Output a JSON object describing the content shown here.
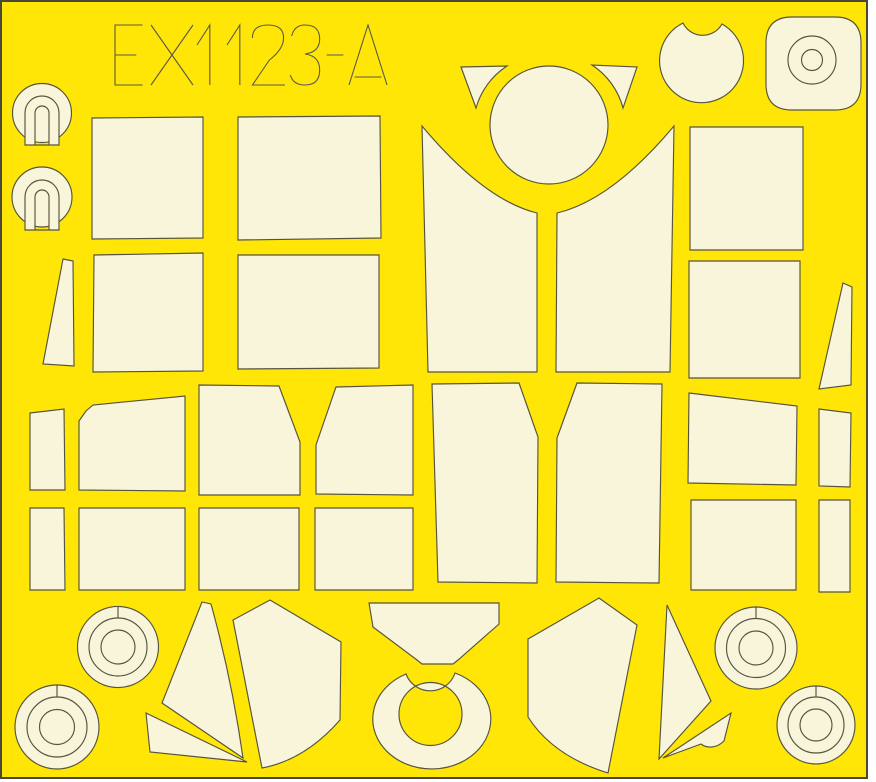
{
  "sheet": {
    "label": "EX1123-A",
    "width": 876,
    "height": 782,
    "colors": {
      "background": "#FFE606",
      "piece": "#F8F5DA",
      "outline": "#55543F",
      "border": "#4A4939",
      "label_stroke": "#5A594A",
      "page": "#FFFFFF"
    },
    "label_layout": {
      "x_positions": [
        115,
        151,
        197,
        227,
        251,
        289,
        325,
        349
      ],
      "glyph_widths": [
        30,
        42,
        22,
        22,
        34,
        32,
        20,
        38
      ],
      "top_y": 25,
      "glyph_height": 60
    }
  },
  "pieces": [
    {
      "name": "gunsight-mask-top-disc",
      "d": "M 12.5 113 A 29.5 29.5 0 1 0 71.5 113 A 29.5 29.5 0 1 0 12.5 113 Z",
      "fill": "piece"
    },
    {
      "name": "gunsight-mask-top-keyhole",
      "d": "M 25 145 L 25 113 A 17 17 0 0 1 59 113 L 59 145 Z M 35 145 L 35 113 A 7 7 0 0 1 49 113 L 49 145 Z",
      "fill": "piece",
      "rule": "evenodd"
    },
    {
      "name": "gunsight-mask-bottom-disc",
      "d": "M 12 197 A 30 30 0 1 0 72 197 A 30 30 0 1 0 12 197 Z",
      "fill": "piece"
    },
    {
      "name": "gunsight-mask-bottom-keyhole",
      "d": "M 25 230 L 25 197 A 17 17 0 0 1 59 197 L 59 230 Z M 35 230 L 35 197 A 7 7 0 0 1 49 197 L 49 230 Z",
      "fill": "piece",
      "rule": "evenodd"
    },
    {
      "name": "fuselage-rect-mask-a1",
      "d": "M 92 118 L 203 117 L 203 238 L 92 239 Z",
      "fill": "piece"
    },
    {
      "name": "fuselage-rect-mask-a2",
      "d": "M 238 117 L 380 116 L 381 238 L 238 240 Z",
      "fill": "piece"
    },
    {
      "name": "fuselage-rect-mask-b1",
      "d": "M 94 255 L 203 253 L 203 371 L 93 372 Z",
      "fill": "piece"
    },
    {
      "name": "fuselage-rect-mask-b2",
      "d": "M 238 255 L 379 255 L 379 368 L 238 369 Z",
      "fill": "piece"
    },
    {
      "name": "edge-wedge-mask-left",
      "d": "M 63 259 L 73 261 L 74 366 L 43 364 Z",
      "fill": "piece"
    },
    {
      "name": "windscreen-quarter-mask-left",
      "d": "M 422 126 Q 484 200 537 213 L 537 372 L 428 372 Z",
      "fill": "piece"
    },
    {
      "name": "windscreen-quarter-mask-right",
      "d": "M 674 126 Q 612 200 557 213 L 556 372 L 670 372 Z",
      "fill": "piece"
    },
    {
      "name": "canopy-crown-circle-mask",
      "d": "M 490 125 A 59 59 0 1 0 608 125 A 59 59 0 1 0 490 125 Z",
      "fill": "piece"
    },
    {
      "name": "horn-triangle-mask-left",
      "d": "M 461 67 L 507 66 A 74 74 0 0 0 476 108 Z",
      "fill": "piece"
    },
    {
      "name": "horn-triangle-mask-right",
      "d": "M 637 67 L 592 65 A 74 74 0 0 1 623 108 Z",
      "fill": "piece"
    },
    {
      "name": "notched-disc-mask",
      "d": "M 683 23 A 42 42 0 1 0 722 24 A 22 22 0 0 1 683 23 Z",
      "fill": "piece"
    },
    {
      "name": "rounded-square-mask",
      "d": "M 792 17 L 835 17 Q 861 17 861 43 L 861 84 Q 861 110 835 110 L 792 110 Q 766 110 766 84 L 766 43 Q 766 17 792 17 Z",
      "fill": "piece"
    },
    {
      "name": "rounded-square-ring-cut",
      "d": "M 788 60 A 24 24 0 1 0 836 60 A 24 24 0 1 0 788 60 Z",
      "fill": "none"
    },
    {
      "name": "rounded-square-hub-cut",
      "d": "M 801.5 60 A 10.5 10.5 0 1 0 822.5 60 A 10.5 10.5 0 1 0 801.5 60 Z",
      "fill": "none"
    },
    {
      "name": "side-rect-mask-right-1",
      "d": "M 690 127 L 803 127 L 803 250 L 690 250 Z",
      "fill": "piece"
    },
    {
      "name": "side-rect-mask-right-2",
      "d": "M 689 261 L 800 261 L 800 378 L 689 378 Z",
      "fill": "piece"
    },
    {
      "name": "tail-wedge-mask-right",
      "d": "M 843 283 L 852 287 L 851 385 L 819 389 Z",
      "fill": "piece"
    },
    {
      "name": "canopy-side-mask-1",
      "d": "M 30 413 L 64 409 L 65 490 L 30 490 Z",
      "fill": "piece"
    },
    {
      "name": "canopy-side-mask-2",
      "d": "M 79 421 L 86 411 L 93 405 L 185 396 L 185 491 L 79 490 Z",
      "fill": "piece"
    },
    {
      "name": "canopy-side-mask-3",
      "d": "M 199 385 L 279 386 L 300 442 L 300 495 L 199 495 Z",
      "fill": "piece"
    },
    {
      "name": "canopy-side-mask-4",
      "d": "M 336 387 L 413 385 L 413 495 L 316 494 L 316 445 Z",
      "fill": "piece"
    },
    {
      "name": "canopy-center-panel-left",
      "d": "M 432 384 L 519 383 L 538 437 L 537 583 L 438 582 Z",
      "fill": "piece"
    },
    {
      "name": "canopy-center-panel-right",
      "d": "M 577 383 L 662 384 L 659 583 L 556 582 L 557 438 Z",
      "fill": "piece"
    },
    {
      "name": "trapezoid-mask-right",
      "d": "M 689 393 L 797 406 L 796 485 L 688 483 Z",
      "fill": "piece"
    },
    {
      "name": "rect-mask-right-lower",
      "d": "M 691 500 L 796 500 L 796 590 L 691 590 Z",
      "fill": "piece"
    },
    {
      "name": "strip-mask-right-upper",
      "d": "M 819 409 L 851 413 L 850 487 L 819 486 Z",
      "fill": "piece"
    },
    {
      "name": "strip-mask-right-lower",
      "d": "M 819 500 L 850 500 L 850 592 L 819 592 Z",
      "fill": "piece"
    },
    {
      "name": "lower-rect-mask-1",
      "d": "M 30 508 L 64 508 L 65 590 L 30 590 Z",
      "fill": "piece"
    },
    {
      "name": "lower-rect-mask-2",
      "d": "M 79 508 L 185 508 L 185 590 L 79 590 Z",
      "fill": "piece"
    },
    {
      "name": "lower-rect-mask-3",
      "d": "M 199 508 L 299 508 L 299 590 L 199 590 Z",
      "fill": "piece"
    },
    {
      "name": "lower-rect-mask-4",
      "d": "M 315 508 L 413 508 L 413 590 L 315 590 Z",
      "fill": "piece"
    },
    {
      "name": "wheel-mask-1-disc",
      "d": "M 77.5 647 A 40.5 40.5 0 1 0 158.5 647 A 40.5 40.5 0 1 0 77.5 647 Z",
      "fill": "piece"
    },
    {
      "name": "wheel-mask-1-ring-cut",
      "d": "M 89 647 A 29 29 0 1 0 147 647 A 29 29 0 1 0 89 647 Z",
      "fill": "none"
    },
    {
      "name": "wheel-mask-1-hub-cut",
      "d": "M 101 647 A 17 17 0 1 0 135 647 A 17 17 0 1 0 101 647 Z",
      "fill": "none"
    },
    {
      "name": "wheel-mask-1-slit",
      "d": "M 118 606.5 L 118 618",
      "fill": "none"
    },
    {
      "name": "wheel-mask-2-disc",
      "d": "M 15 727 A 42 42 0 1 0 99 727 A 42 42 0 1 0 15 727 Z",
      "fill": "piece"
    },
    {
      "name": "wheel-mask-2-ring-cut",
      "d": "M 27 727 A 30 30 0 1 0 87 727 A 30 30 0 1 0 27 727 Z",
      "fill": "none"
    },
    {
      "name": "wheel-mask-2-hub-cut",
      "d": "M 39.5 727 A 17.5 17.5 0 1 0 74.5 727 A 17.5 17.5 0 1 0 39.5 727 Z",
      "fill": "none"
    },
    {
      "name": "wheel-mask-2-slit",
      "d": "M 57 685 L 57 697",
      "fill": "none"
    },
    {
      "name": "wheel-mask-3-disc",
      "d": "M 715 648 A 41 41 0 1 0 797 648 A 41 41 0 1 0 715 648 Z",
      "fill": "piece"
    },
    {
      "name": "wheel-mask-3-ring-cut",
      "d": "M 726.5 648 A 29.5 29.5 0 1 0 785.5 648 A 29.5 29.5 0 1 0 726.5 648 Z",
      "fill": "none"
    },
    {
      "name": "wheel-mask-3-hub-cut",
      "d": "M 739 648 A 17 17 0 1 0 773 648 A 17 17 0 1 0 739 648 Z",
      "fill": "none"
    },
    {
      "name": "wheel-mask-3-slit",
      "d": "M 756 607 L 756 618.5",
      "fill": "none"
    },
    {
      "name": "wheel-mask-4-disc",
      "d": "M 777 725 A 39 39 0 1 0 855 725 A 39 39 0 1 0 777 725 Z",
      "fill": "piece"
    },
    {
      "name": "wheel-mask-4-ring-cut",
      "d": "M 788 725 A 28 28 0 1 0 844 725 A 28 28 0 1 0 788 725 Z",
      "fill": "none"
    },
    {
      "name": "wheel-mask-4-hub-cut",
      "d": "M 800 725 A 16 16 0 1 0 832 725 A 16 16 0 1 0 800 725 Z",
      "fill": "none"
    },
    {
      "name": "wheel-mask-4-slit",
      "d": "M 816 686 L 816 697",
      "fill": "none"
    },
    {
      "name": "blade-mask-left",
      "d": "M 202 602 L 211 604 Q 232 680 243 758 L 162 703 Z",
      "fill": "piece"
    },
    {
      "name": "sliver-mask-left",
      "d": "M 146 713 L 247 762 L 150 752 Z",
      "fill": "piece"
    },
    {
      "name": "quarter-panel-mask-left",
      "d": "M 270 600 L 341 642 L 340 720 Q 305 760 262 768 L 233 620 Z",
      "fill": "piece"
    },
    {
      "name": "windscreen-front-mask",
      "d": "M 369 603 L 499 603 L 499 624 L 458 660 L 453 664 L 422 664 L 417 660 L 373 627 Z",
      "fill": "piece"
    },
    {
      "name": "spinner-ring-mask",
      "d": "M 406 674 A 59 50 0 1 0 455 673 A 26 26 0 0 1 406 674 Z M 462 714 A 31.5 31.5 0 1 0 399 714 A 31.5 31.5 0 1 0 462 714 Z",
      "fill": "piece",
      "rule": "evenodd"
    },
    {
      "name": "quarter-panel-mask-right",
      "d": "M 599 598 L 637 625 L 608 773 Q 553 756 528 717 L 528 639 Z",
      "fill": "piece"
    },
    {
      "name": "blade-mask-right",
      "d": "M 667 605 L 711 701 L 659 759 Z",
      "fill": "piece"
    },
    {
      "name": "notch-wedge-mask-right",
      "d": "M 663 758 L 731 713 L 724 741 C 716 749 706 748 701 744 Z",
      "fill": "piece"
    }
  ]
}
